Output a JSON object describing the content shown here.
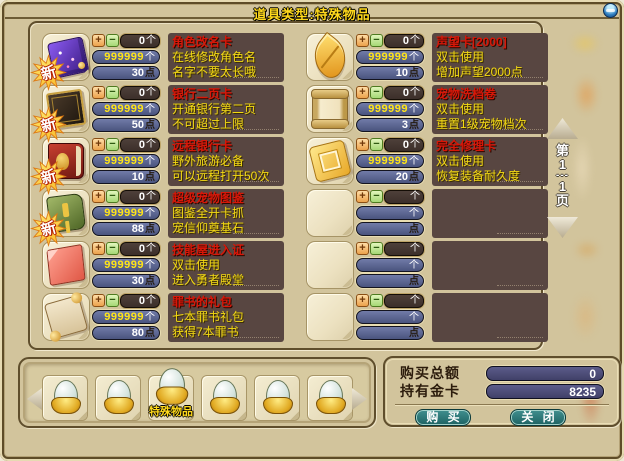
{
  "window": {
    "title": "道具类型:特殊物品"
  },
  "badge_new": "新",
  "units": {
    "count": "个",
    "points": "点"
  },
  "controls": {
    "plus": "+",
    "minus": "−"
  },
  "pagination": {
    "prefix": "第",
    "current": "1",
    "separator": "---",
    "total": "1",
    "suffix": "页"
  },
  "columns": {
    "left": [
      {
        "icon": "rename-card",
        "title": "角色改名卡",
        "desc1": "在线修改角色名",
        "desc2": "名字不要太长哦",
        "qty": "0",
        "stock": "999999",
        "price": "30",
        "new": true
      },
      {
        "icon": "bank-page-card",
        "title": "银行二页卡",
        "desc1": "开通银行第二页",
        "desc2": "不可超过上限",
        "qty": "0",
        "stock": "999999",
        "price": "50",
        "new": true
      },
      {
        "icon": "remote-bank-card",
        "title": "远程银行卡",
        "desc1": "野外旅游必备",
        "desc2": "可以远程打开50次",
        "qty": "0",
        "stock": "999999",
        "price": "10",
        "new": true
      },
      {
        "icon": "super-pet-atlas",
        "title": "超级宠物图鉴",
        "desc1": "图鉴全开卡抓",
        "desc2": "宠信仰奠基石",
        "qty": "0",
        "stock": "999999",
        "price": "88",
        "new": true
      },
      {
        "icon": "skill-house-pass",
        "title": "技能屋进入证",
        "desc1": "双击使用",
        "desc2": "进入勇者殿堂",
        "qty": "0",
        "stock": "999999",
        "price": "30",
        "new": false
      },
      {
        "icon": "sin-book-pack",
        "title": "罪书的礼包",
        "desc1": "七本罪书礼包",
        "desc2": "获得7本罪书",
        "qty": "0",
        "stock": "999999",
        "price": "80",
        "new": false
      }
    ],
    "right": [
      {
        "icon": "reputation-card",
        "title": "声望卡[2000]",
        "desc1": "双击使用",
        "desc2": "增加声望2000点",
        "qty": "0",
        "stock": "999999",
        "price": "10",
        "new": false
      },
      {
        "icon": "pet-reset-scroll",
        "title": "宠物洗档卷",
        "desc1": "双击使用",
        "desc2": "重置1级宠物档次",
        "qty": "0",
        "stock": "999999",
        "price": "3",
        "new": false
      },
      {
        "icon": "full-repair-card",
        "title": "完全修理卡",
        "desc1": "双击使用",
        "desc2": "恢复装备耐久度",
        "qty": "0",
        "stock": "999999",
        "price": "20",
        "new": false
      },
      {
        "icon": "empty",
        "title": "",
        "desc1": "",
        "desc2": "",
        "qty": "",
        "stock": "",
        "price": "",
        "new": false
      },
      {
        "icon": "empty",
        "title": "",
        "desc1": "",
        "desc2": "",
        "qty": "",
        "stock": "",
        "price": "",
        "new": false
      },
      {
        "icon": "empty",
        "title": "",
        "desc1": "",
        "desc2": "",
        "qty": "",
        "stock": "",
        "price": "",
        "new": false
      }
    ]
  },
  "tray": {
    "category_label": "特殊物品"
  },
  "purchase": {
    "total_label": "购买总额",
    "total_value": "0",
    "held_label": "持有金卡",
    "held_value": "8235",
    "buy_label": "购 买",
    "close_label": "关 闭"
  },
  "colors": {
    "background_tan": "#d2c49c",
    "accent_yellow": "#ffd91c",
    "item_title_red": "#d81708",
    "desc_text_yellow": "#f4da12",
    "desc_box_brown": "#584641",
    "field_blue": "#5a648e",
    "button_teal": "#2d7a78",
    "value_field_navy": "#4a4a72"
  }
}
